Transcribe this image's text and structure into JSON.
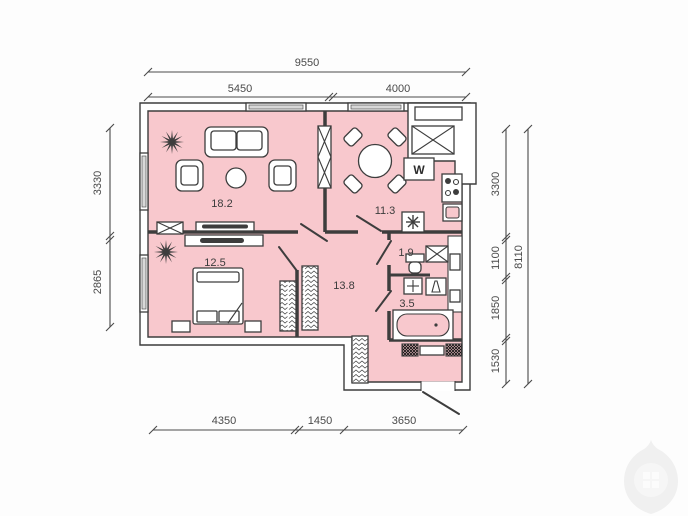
{
  "plan": {
    "rooms": [
      {
        "name": "living-room",
        "area": "18.2"
      },
      {
        "name": "kitchen",
        "area": "11.3"
      },
      {
        "name": "bedroom",
        "area": "12.5"
      },
      {
        "name": "wc",
        "area": "1.9"
      },
      {
        "name": "hallway",
        "area": "13.8"
      },
      {
        "name": "bathroom",
        "area": "3.5"
      }
    ],
    "appliances": {
      "washer": "W"
    },
    "dimensions": {
      "top": {
        "total": "9550",
        "left": "5450",
        "right": "4000"
      },
      "left": {
        "top": "3330",
        "bottom": "2865"
      },
      "right": {
        "s1": "3300",
        "s2": "1100",
        "s3": "1850",
        "s4": "1530",
        "total": "8110"
      },
      "bottom": {
        "s1": "4350",
        "s2": "1450",
        "s3": "3650"
      }
    },
    "colors": {
      "room_fill": "#f8c8cd",
      "wall": "#3d3d3d",
      "dim_text": "#4a4a4a",
      "watermark": "#f0f0f0"
    }
  }
}
